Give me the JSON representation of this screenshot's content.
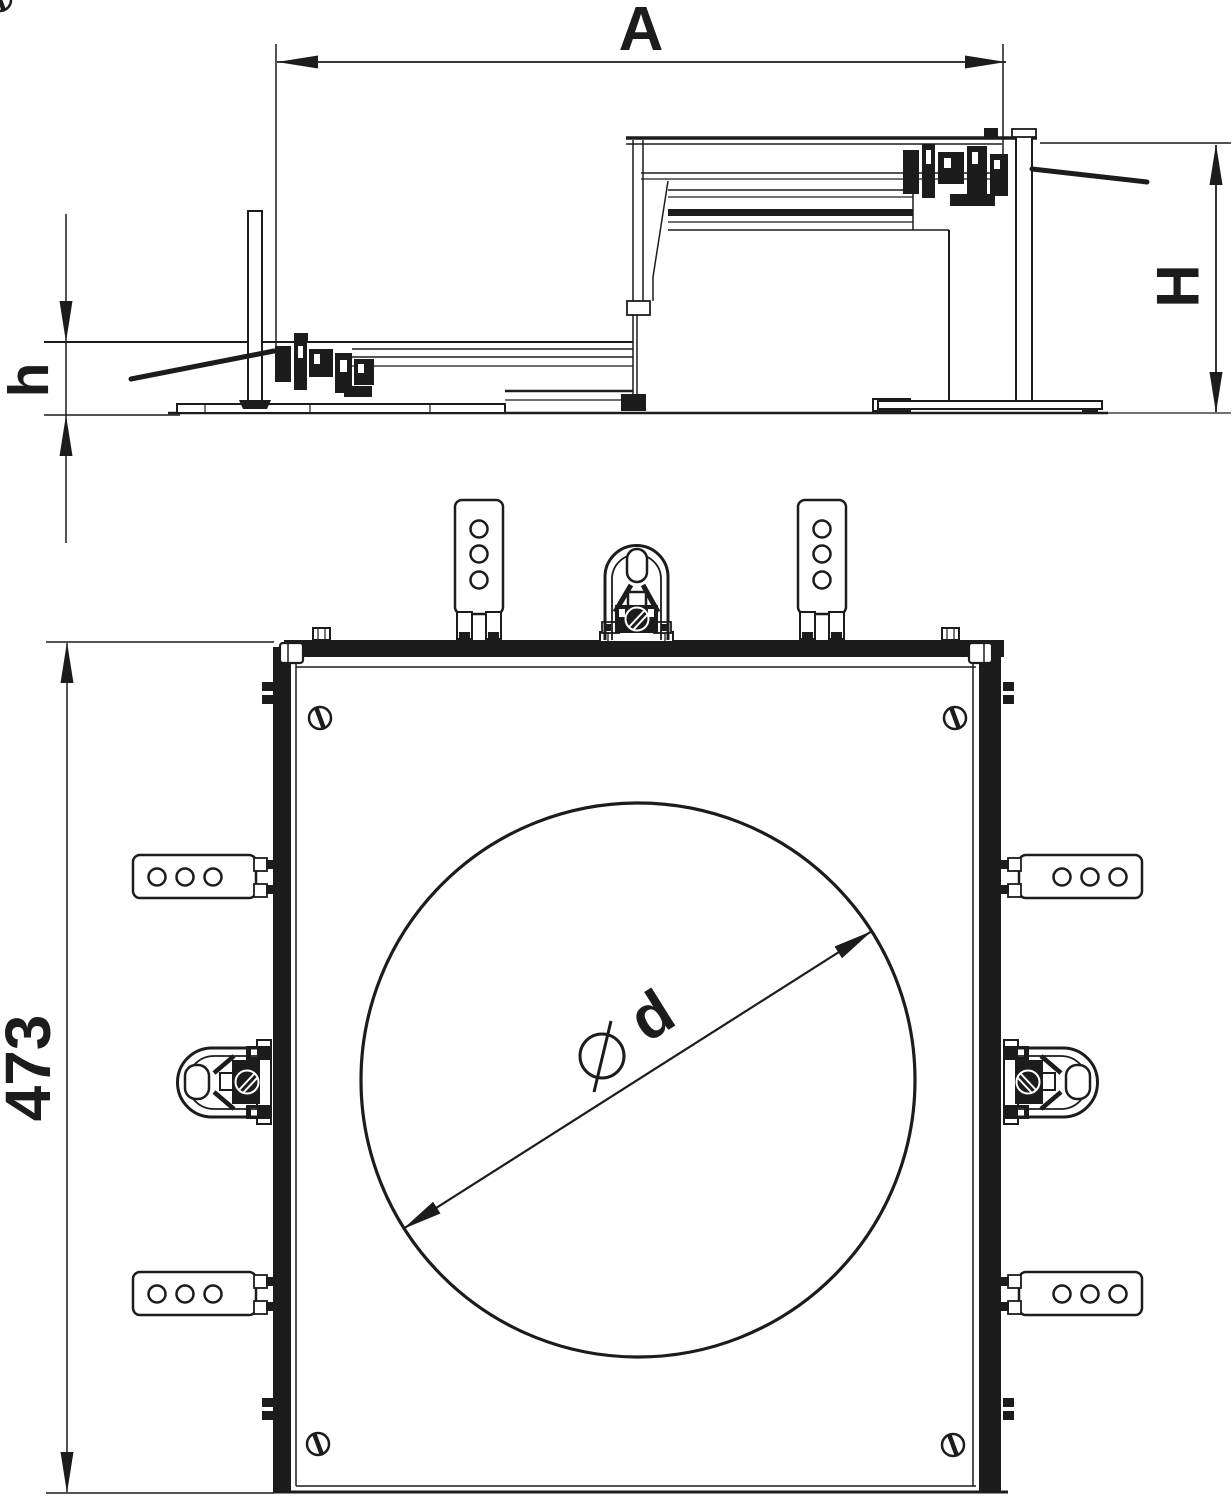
{
  "drawing": {
    "background": "#ffffff",
    "line_color": "#1c1c1c",
    "labels": {
      "width": "A",
      "height_max": "H",
      "height_min": "h",
      "frame_width": "473",
      "diameter": "d",
      "diameter_symbol": "⌀"
    }
  }
}
